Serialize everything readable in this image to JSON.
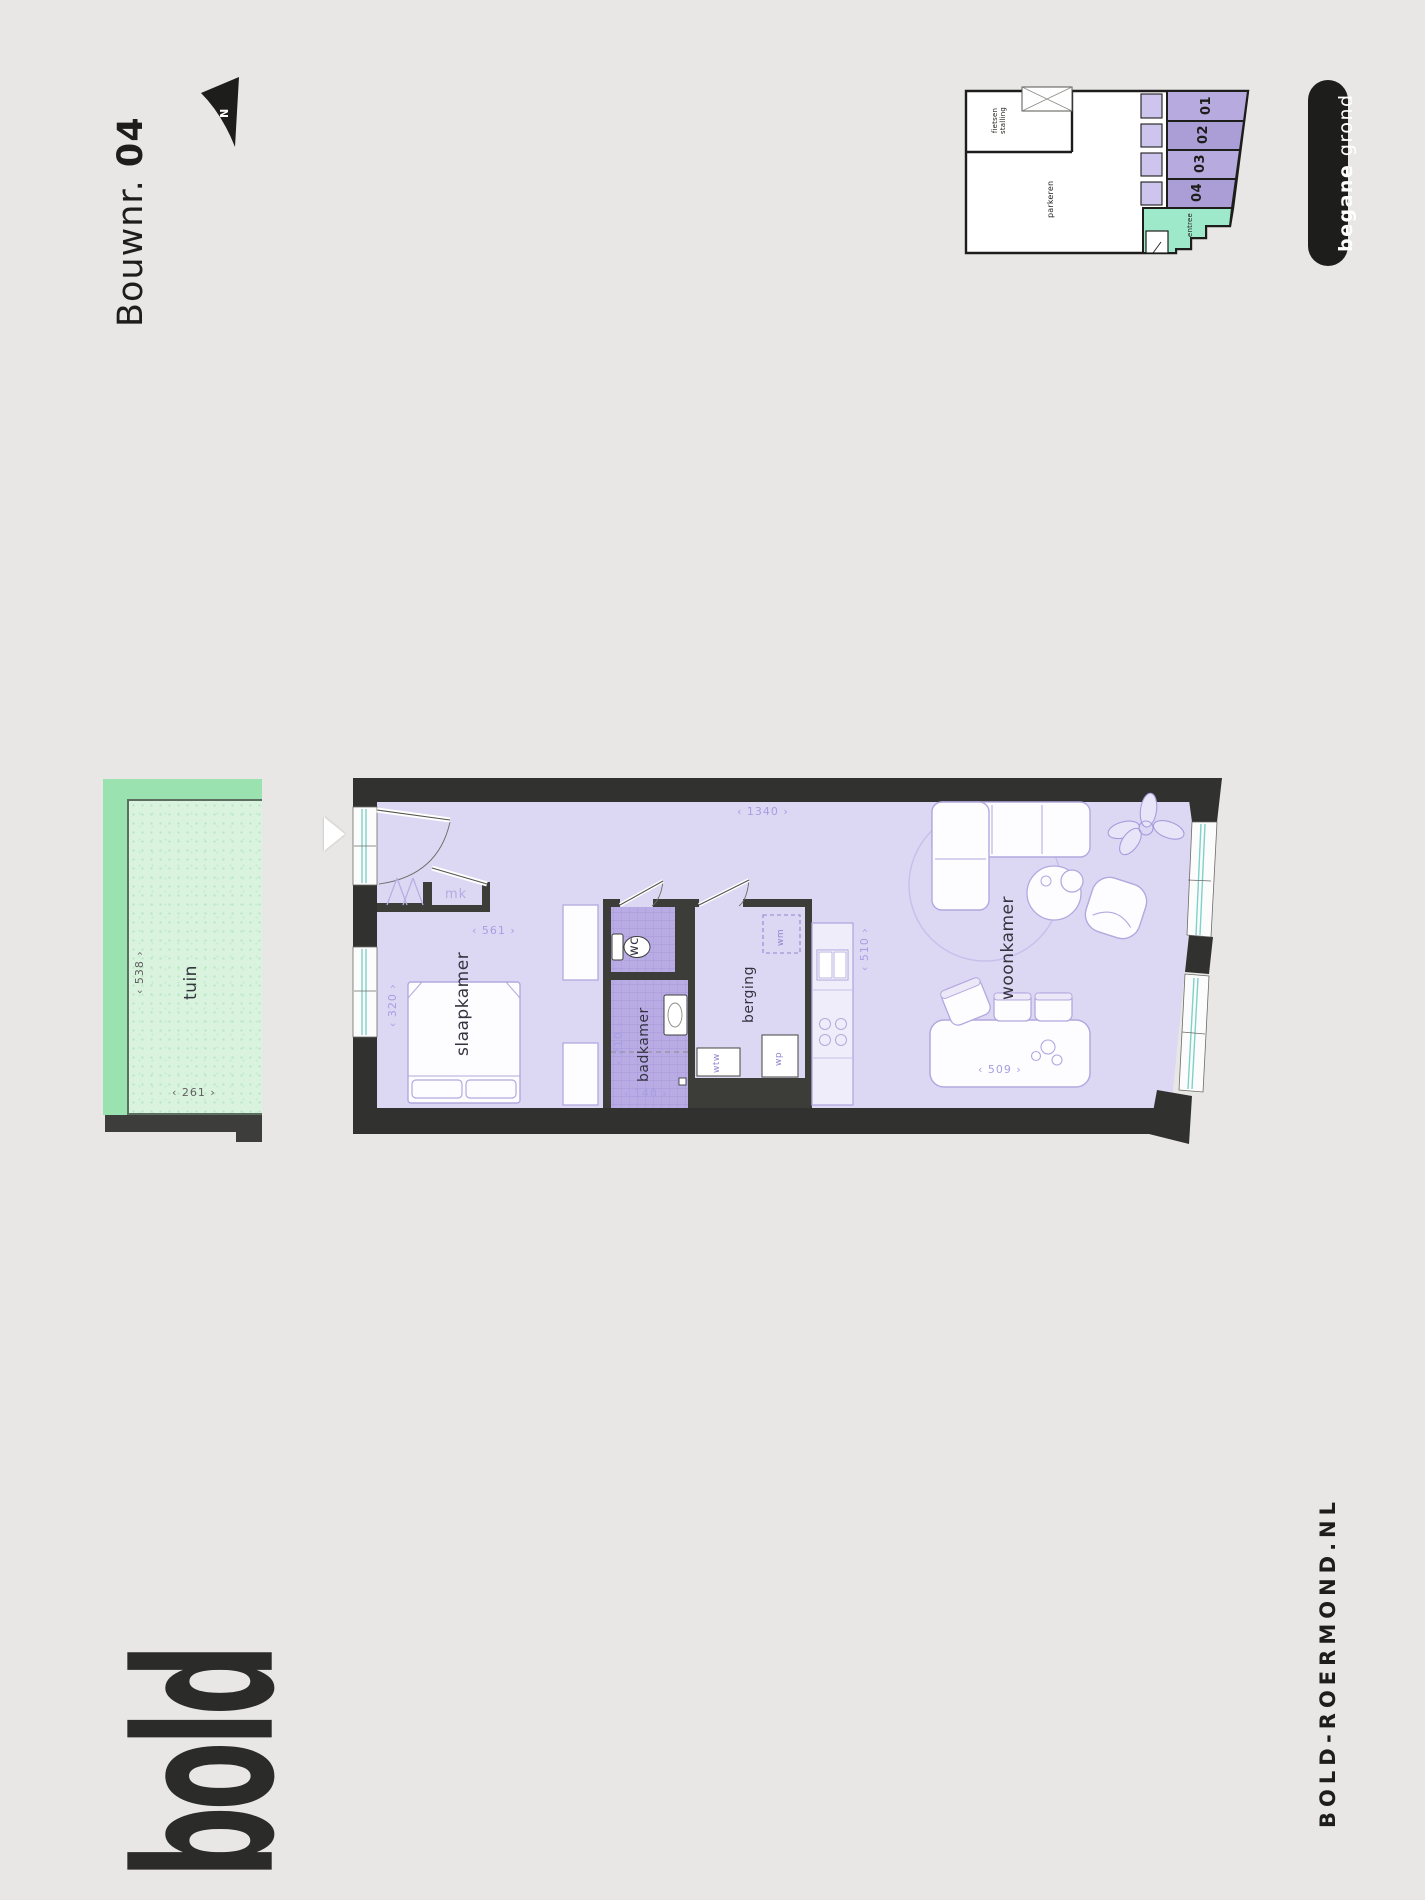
{
  "title": {
    "label": "Bouwnr.",
    "number": "04"
  },
  "compass": {
    "label": "N"
  },
  "site_plan": {
    "bike_storage_line1": "fietsen",
    "bike_storage_line2": "stalling",
    "parking": "parkeren",
    "entrance": "entree",
    "units": [
      "01",
      "02",
      "03",
      "04"
    ]
  },
  "level_badge": {
    "emphasis": "begane",
    "rest": "grond"
  },
  "garden": {
    "label": "tuin",
    "width_dim": "‹ 538 ›",
    "depth_dim": "‹ 261 ›"
  },
  "floor_plan": {
    "rooms": {
      "bedroom": "slaapkamer",
      "bathroom": "badkamer",
      "toilet": "wc",
      "storage": "berging",
      "living": "woonkamer"
    },
    "closets": {
      "meter_closet": "mk",
      "washing_machine": "wm",
      "heat_recovery": "wtw",
      "heat_pump": "wp"
    },
    "dimensions": {
      "hall_width": "‹ 561 ›",
      "bedroom_width": "‹ 320 ›",
      "total_length": "‹ 1340 ›",
      "bathroom_length": "‹ 210 ›",
      "bathroom_width": "‹ 140 ›",
      "kitchen_length": "‹ 510 ›",
      "table_width": "‹ 509 ›"
    }
  },
  "footer": {
    "logo": "bold",
    "website": "BOLD-ROERMOND.NL"
  },
  "colors": {
    "background": "#e8e7e5",
    "ink": "#1d1d1b",
    "wall": "#31312f",
    "floor_purple": "#dcd8f3",
    "tile_purple": "#b9abe4",
    "unit_purple": "#b6a9de",
    "mint": "#9fe9cb",
    "garden_green": "#9ae2b0",
    "window_teal": "#7fd2c8"
  }
}
